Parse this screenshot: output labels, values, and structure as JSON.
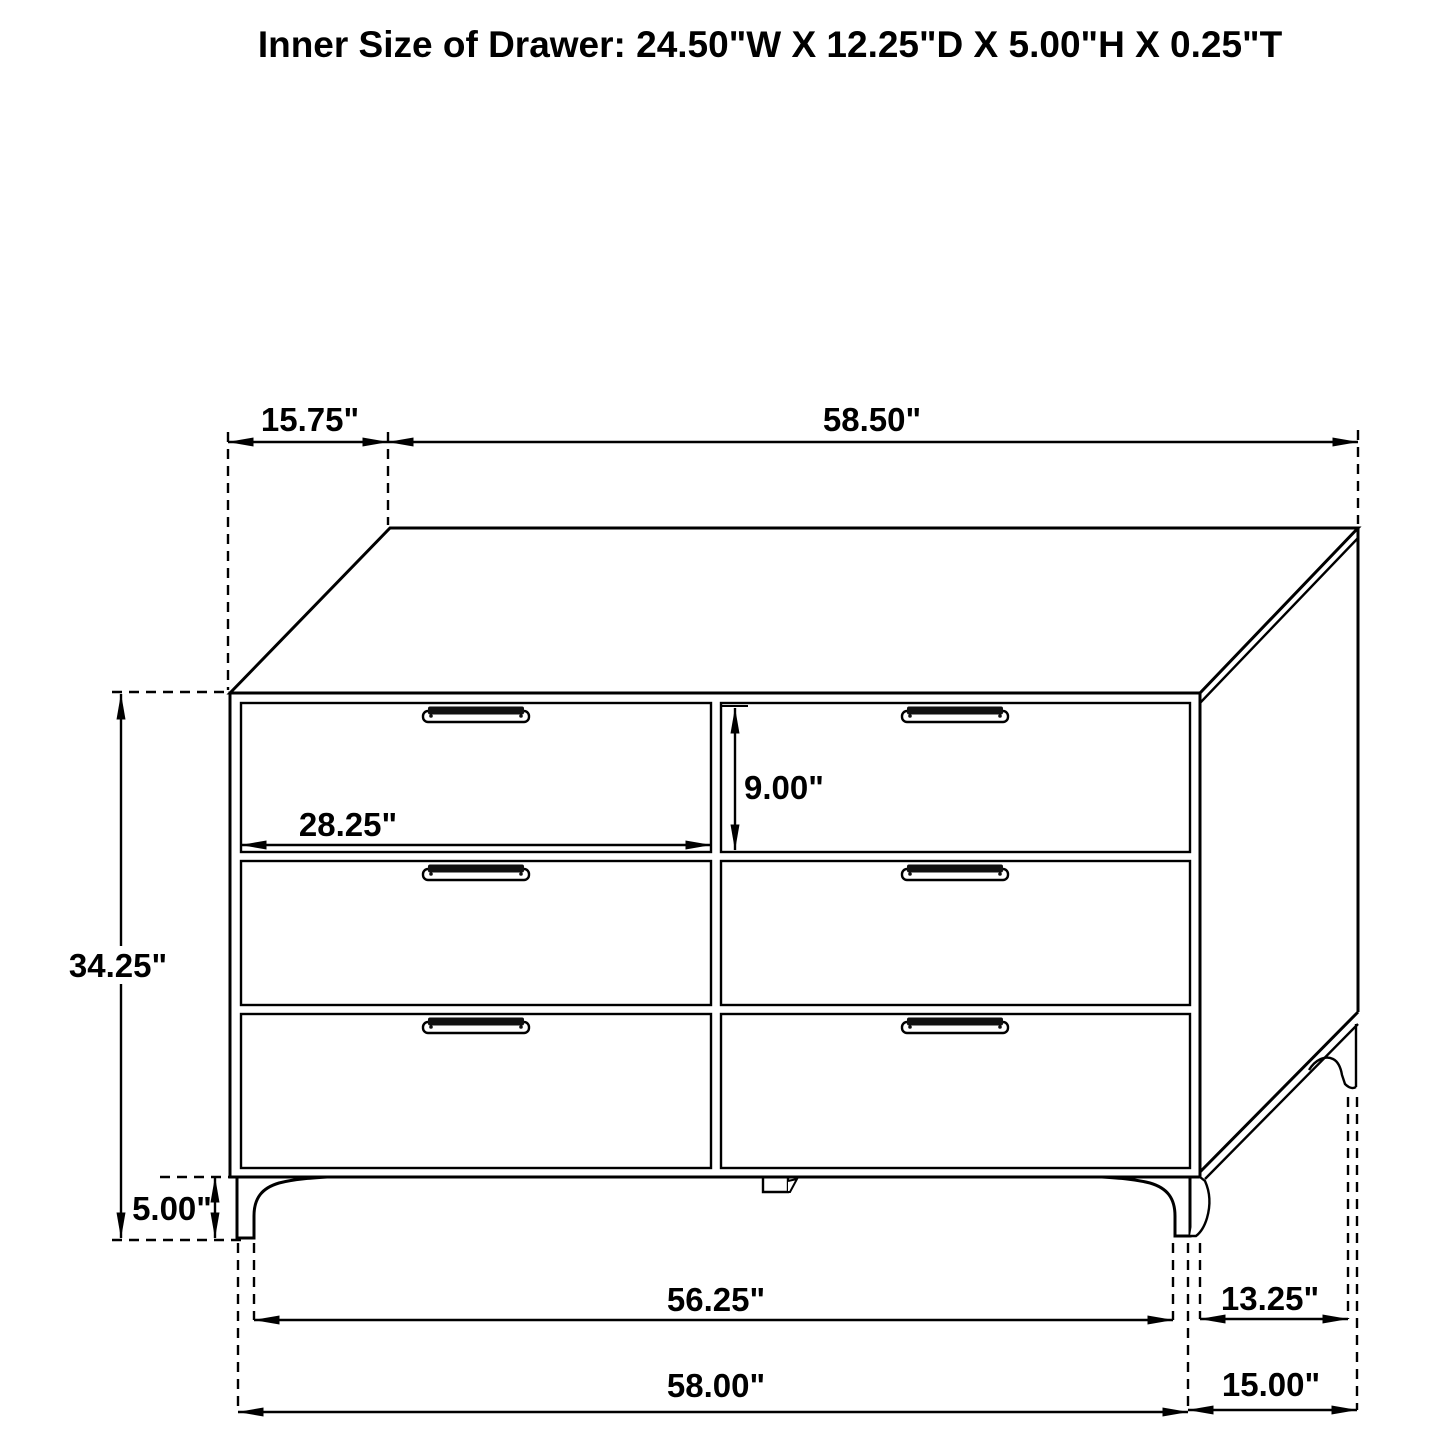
{
  "title": "Inner Size of Drawer: 24.50\"W X 12.25\"D X 5.00\"H X 0.25\"T",
  "diagram": {
    "object": "six-drawer-dresser-dimension-drawing",
    "background_color": "#ffffff",
    "line_color": "#000000",
    "dimensions": {
      "top_depth": "15.75\"",
      "top_width": "58.50\"",
      "drawer_height": "9.00\"",
      "drawer_width": "28.25\"",
      "overall_height": "34.25\"",
      "leg_height": "5.00\"",
      "feet_inner_width": "56.25\"",
      "base_width": "58.00\"",
      "side_feet_span": "13.25\"",
      "base_depth": "15.00\""
    }
  }
}
